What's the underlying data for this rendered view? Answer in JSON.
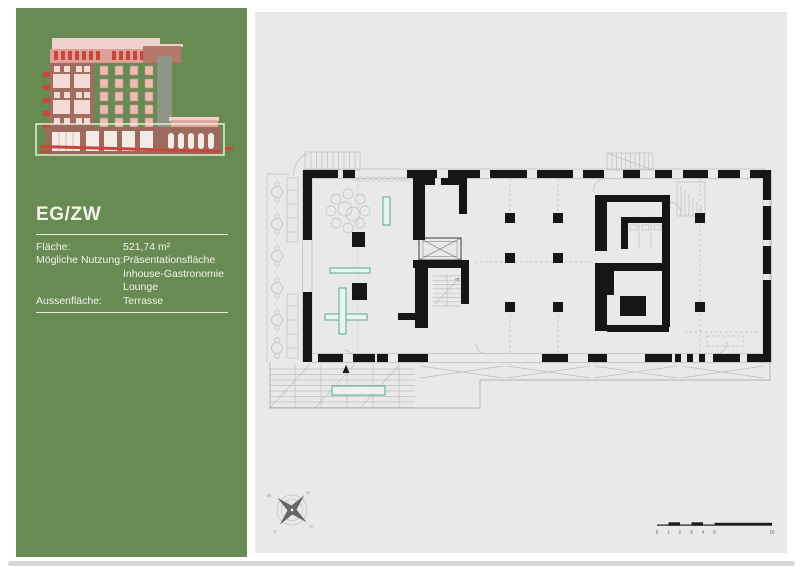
{
  "sidebar": {
    "panel_color": "#688b53",
    "text_color": "#f2f4ea",
    "title": "EG/ZW",
    "info": {
      "flaeche_label": "Fläche:",
      "flaeche_value": "521,74 m²",
      "nutzung_label": "Mögliche Nutzung:",
      "nutzung_values": [
        "Präsentationsfläche",
        "Inhouse-Gastronomie",
        "Lounge"
      ],
      "aussen_label": "Aussenfläche:",
      "aussen_value": "Terrasse"
    }
  },
  "plan": {
    "paper_color": "#e9eae8",
    "wall_color": "#161616",
    "line_color": "#bdbdc1",
    "accent_teal": "#4aa08f",
    "compass": {
      "n": "N",
      "e": "O",
      "s": "S",
      "w": "W"
    },
    "scale_bar": {
      "ticks": [
        "0",
        "1",
        "2",
        "3",
        "4",
        "5",
        "10"
      ]
    }
  },
  "elevation": {
    "pink_light": "#f0d2cc",
    "salmon": "#dfa197",
    "red": "#c8473a",
    "brick": "#a06e60",
    "tower_gray": "#8e9582",
    "highlight_outline": "#eef2e2"
  }
}
